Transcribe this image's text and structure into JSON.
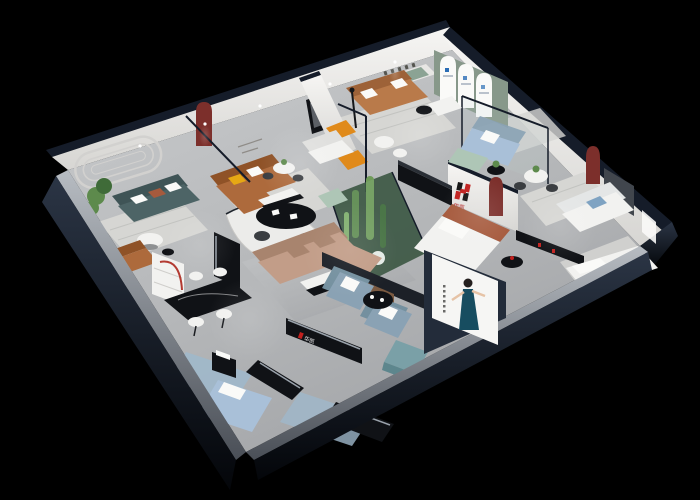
{
  "scene": {
    "title": "isometric-furniture-showroom-cutaway-render",
    "background": "#000000",
    "view": "3d-dollhouse-top-oblique"
  },
  "brand": {
    "name": "华凯",
    "logo_mark": "H",
    "logo_red": "#c1201e",
    "logo_black": "#141414",
    "sign_locations": [
      "feature-wall",
      "reception-shelf",
      "arch-gallery-panels"
    ]
  },
  "poster": {
    "subject": "woman in teal evening dress",
    "background": "#f6f6f4",
    "dress_color": "#174d60",
    "vertical_text_marks": 6
  },
  "wall_plaque": {
    "text_marks": 5
  },
  "rooms": [
    "teal-sofa-lounge",
    "cognac-sofa-room",
    "caramel-sofa-room",
    "arch-gallery-room",
    "glass-meeting-room",
    "central-cactus-atrium",
    "tan-sectional-lounge",
    "dining-area",
    "bedroom-display",
    "right-wing-displays",
    "reception",
    "front-display-strip"
  ],
  "palette": {
    "bg": "#000000",
    "navy_wall": "#232c3a",
    "navy_edge": "#151c29",
    "wall_white": "#e7e6e4",
    "wall_white_top": "#f5f4f2",
    "wall_shade": "#d0cfcc",
    "floor": "#b7b9bb",
    "floor_dark": "#9fa1a4",
    "bevel_light": "#b4b9bf",
    "bevel_dark": "#4e535b",
    "rug_light": "#d6d6d3",
    "rug_stripe": "#c2c3c0",
    "rug_blue": "#9fb8cb",
    "green_wall": "#87988a",
    "arch_red": "#7c2f2b",
    "sofa_cognac": "#ad6a3c",
    "sofa_cognac_dark": "#8f5227",
    "sofa_caramel": "#b97a4a",
    "sofa_caramel_dark": "#9d6238",
    "sofa_tan": "#c29d88",
    "sofa_tan_dark": "#a8846e",
    "sofa_teal": "#4d6466",
    "sofa_teal_dark": "#3f5456",
    "sofa_bluegray": "#8aa2b4",
    "sofa_lightblue": "#a9c0d8",
    "mint": "#aec6b6",
    "teal_ottoman": "#7aa0a7",
    "teal_ottoman_dark": "#5d868d",
    "accent_orange": "#e08a1a",
    "accent_yellow": "#e6a814",
    "plant": "#5d8a4c",
    "plant_dark": "#3f6b38",
    "atrium_floor": "#2f4a34",
    "black_furniture": "#101216",
    "gray_furniture": "#3a3d41",
    "white_furniture": "#f2f2f0",
    "paper_white": "#fafaf8",
    "brand_red": "#c1201e",
    "brand_black": "#141414",
    "poster_bg": "#f6f6f4",
    "poster_dress": "#174d60",
    "skin": "#e6c3a6",
    "glass": "#bcd8d8",
    "blue_logo": "#2a6db5",
    "terracotta": "#a65a3d",
    "wood": "#7b5a41",
    "molding": "#d2d1cf",
    "micro_text": "#8f8c88",
    "chrome": "#9aa2ab",
    "lamp_red": "#b33a31"
  }
}
